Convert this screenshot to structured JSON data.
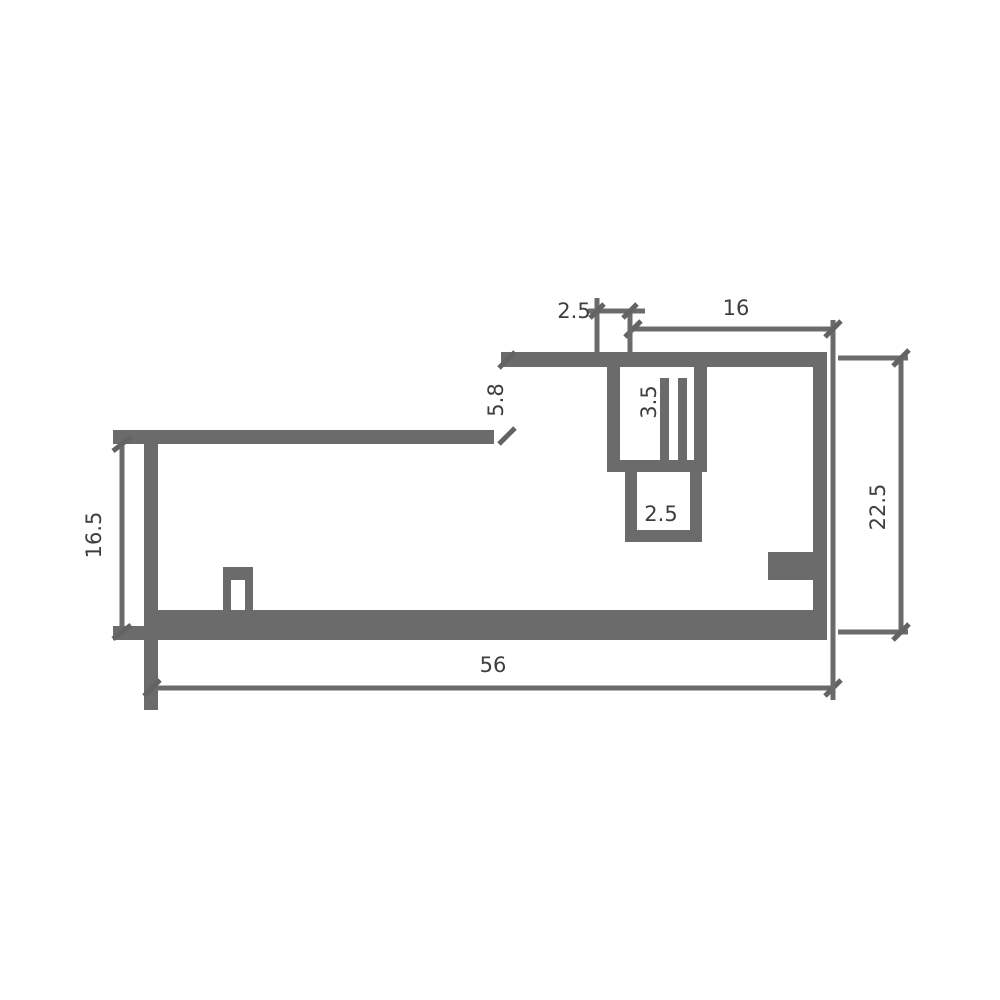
{
  "drawing": {
    "title": "profile-cross-section-dimension-drawing",
    "type": "technical CAD cross-section of an extruded profile",
    "background_color": "#ffffff",
    "line_color": "#6b6b6b",
    "text_color": "#3e3e3e",
    "dimensions": {
      "top_small": "2.5",
      "top_width": "16",
      "step_height": "5.8",
      "channel_upper": "3.5",
      "channel_lower": "2.5",
      "left_height": "16.5",
      "right_height": "22.5",
      "overall_width": "56"
    }
  }
}
